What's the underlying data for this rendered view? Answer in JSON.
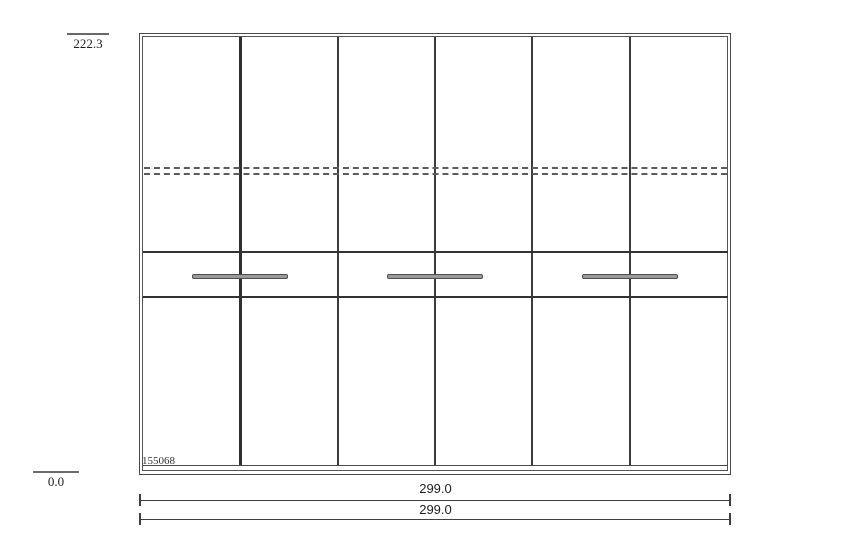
{
  "drawing": {
    "type": "wardrobe-front-elevation",
    "item_number": "155068",
    "height_label": "222.3",
    "baseline_label": "0.0",
    "width_labels": [
      "299.0",
      "299.0"
    ],
    "door_count": 6,
    "drawer_handle_count": 3,
    "dashed_rail_count": 2,
    "colors": {
      "line": "#3f3f3f",
      "handle": "#9a9a9a",
      "background": "#ffffff"
    }
  }
}
